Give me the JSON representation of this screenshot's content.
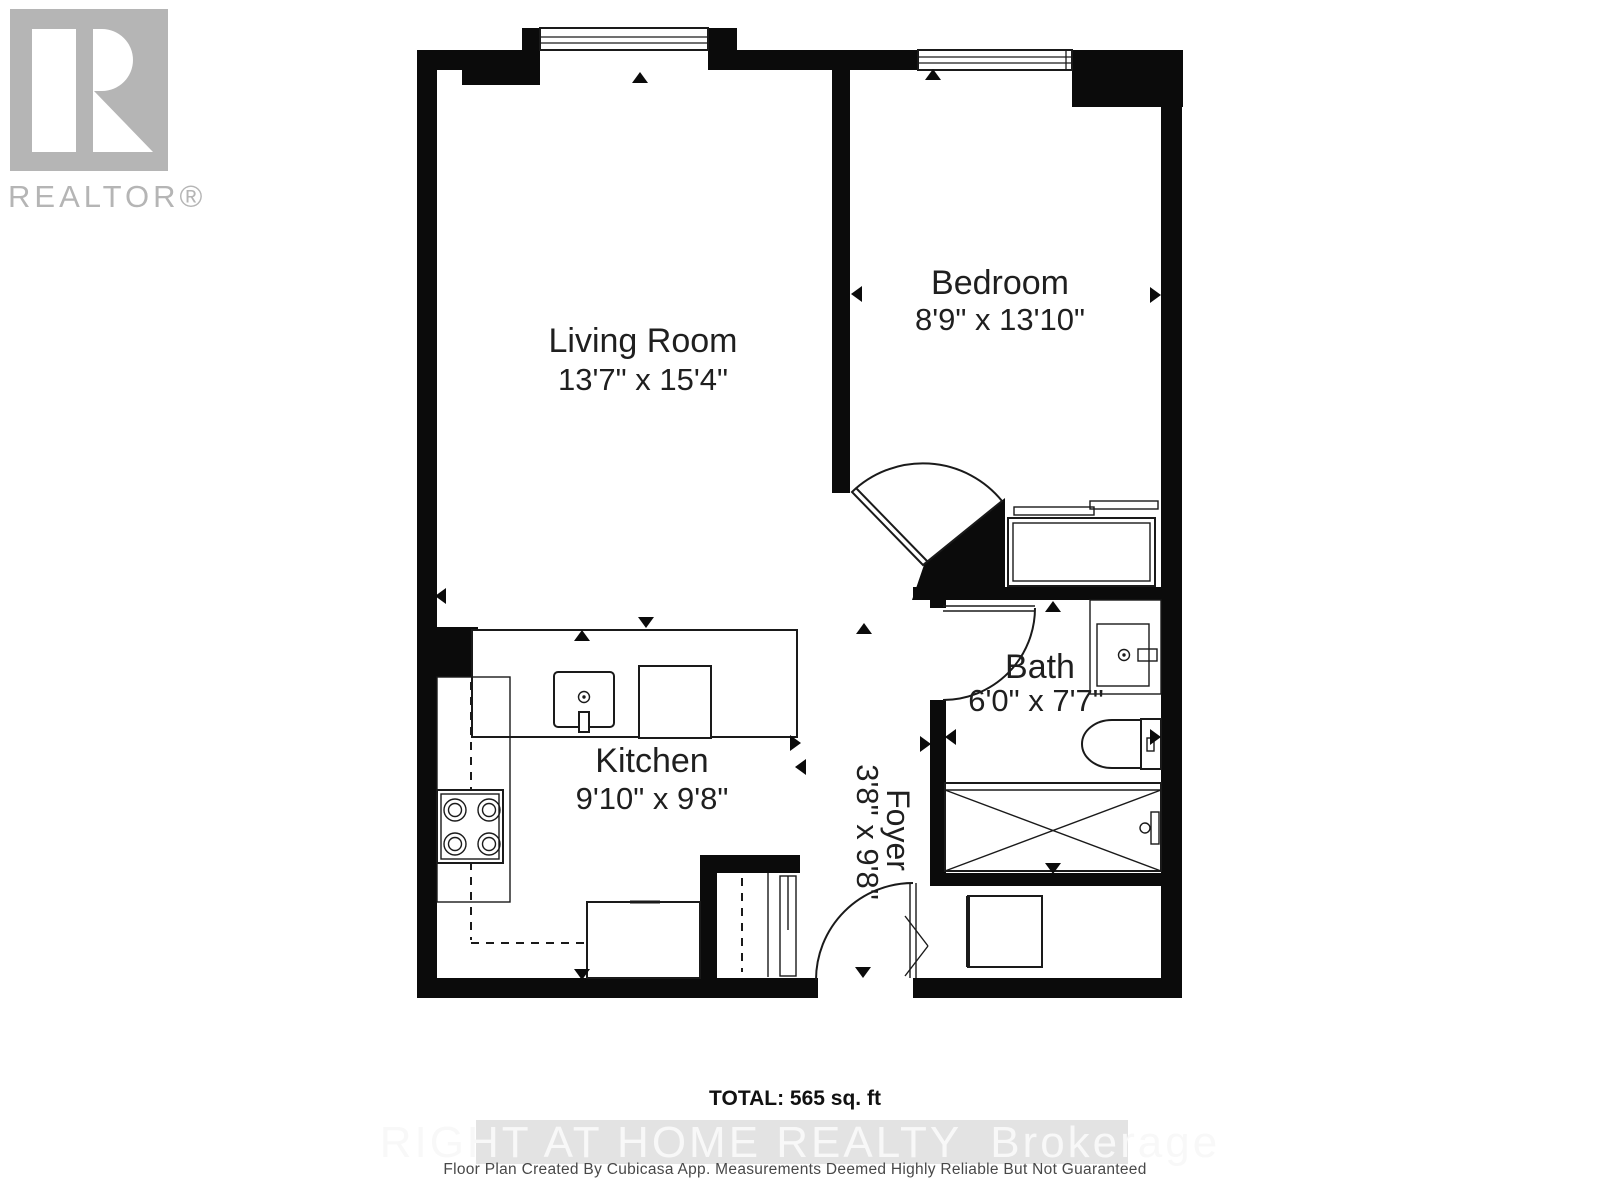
{
  "branding": {
    "logo_label": "REALTOR®"
  },
  "plan": {
    "rooms": [
      {
        "id": "living-room",
        "name": "Living Room",
        "dims": "13'7\" x 15'4\""
      },
      {
        "id": "bedroom",
        "name": "Bedroom",
        "dims": "8'9\" x 13'10\""
      },
      {
        "id": "kitchen",
        "name": "Kitchen",
        "dims": "9'10\" x 9'8\""
      },
      {
        "id": "bath",
        "name": "Bath",
        "dims": "6'0\" x 7'7\""
      },
      {
        "id": "foyer",
        "name": "Foyer",
        "dims": "3'8\" x 9'8\""
      }
    ]
  },
  "footer": {
    "total_label": "TOTAL: 565 sq. ft",
    "watermark_main": "RIGHT AT HOME REALTY",
    "watermark_suffix": "Brokerage",
    "disclaimer": "Floor Plan Created By Cubicasa App. Measurements Deemed Highly Reliable But Not Guaranteed"
  },
  "colors": {
    "wall": "#0b0b0b",
    "logo_gray": "#b5b5b5",
    "watermark_band": "#e3e3e3",
    "watermark_text": "#f8f8f8",
    "disclaimer": "#484848"
  }
}
